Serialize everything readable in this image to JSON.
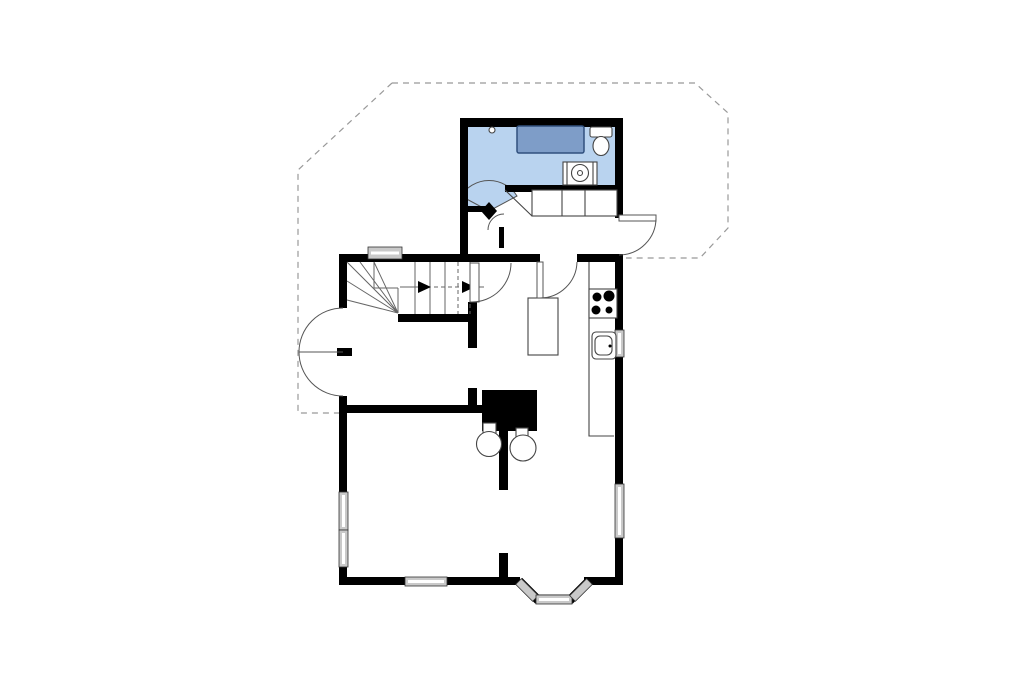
{
  "document": {
    "type": "floor-plan",
    "text_labels": []
  },
  "colors": {
    "background": "#ffffff",
    "wall": "#000000",
    "bathroom_floor": "#b9d3ef",
    "bathtub": "#7e9dc8",
    "bathtub_border": "#30507e",
    "window_fill": "#c9c9c9",
    "window_stroke": "#333333",
    "fixture_line": "#444444",
    "door_line": "#555555",
    "stair_line": "#666666",
    "dashed_outline": "#999999"
  },
  "rooms": [
    {
      "name": "bathroom",
      "floor_color": "#b9d3ef",
      "fixtures": [
        "bathtub",
        "toilet",
        "washing-machine",
        "floor-drain"
      ]
    },
    {
      "name": "entrance-hall",
      "fixtures": [
        "wardrobe"
      ]
    },
    {
      "name": "kitchen-living-room",
      "fixtures": [
        "kitchen-counter",
        "cooktop-4-burners",
        "sink",
        "island-table",
        "wood-stove",
        "wood-stove",
        "chimney"
      ]
    },
    {
      "name": "room-middle-left",
      "fixtures": []
    },
    {
      "name": "room-bottom-left",
      "fixtures": []
    }
  ],
  "stairs": {
    "winder": true,
    "direction_arrows": 2,
    "arrow_direction": "right"
  },
  "doors": [
    "bathroom-door",
    "hall-closet-door",
    "entrance-door",
    "hall-to-kitchen-door",
    "stair-room-door",
    "french-double-door"
  ],
  "windows": [
    "stair-window",
    "left-wall-window-upper",
    "left-wall-window-lower",
    "bottom-wall-window",
    "bay-window-left",
    "bay-window-front",
    "bay-window-right",
    "kitchen-sink-window",
    "right-wall-window"
  ],
  "outline": {
    "style": "dashed"
  }
}
